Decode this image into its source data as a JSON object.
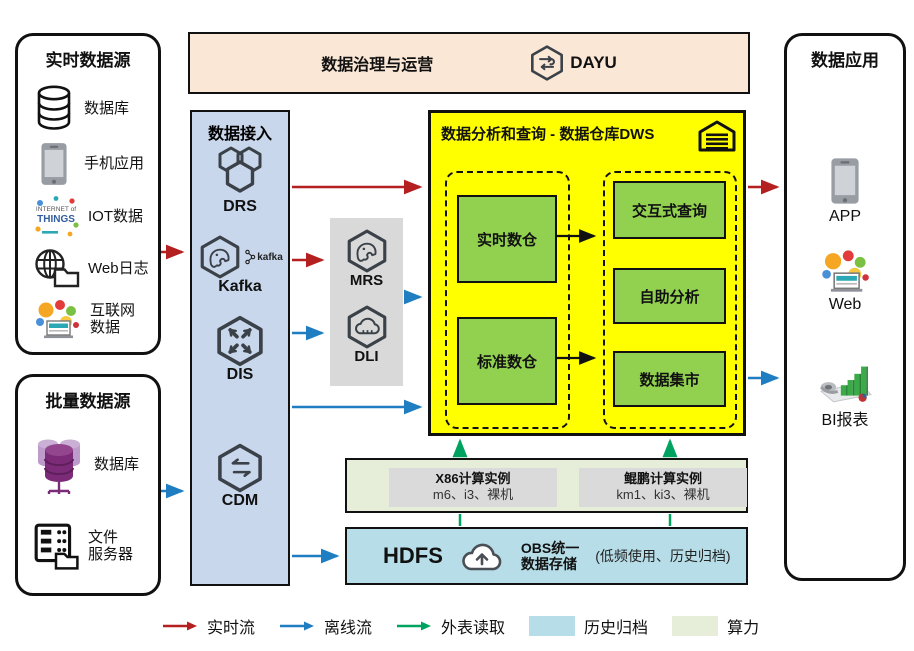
{
  "realtime_panel": {
    "title": "实时数据源",
    "items": [
      {
        "label": "数据库"
      },
      {
        "label": "手机应用"
      },
      {
        "label": "IOT数据"
      },
      {
        "label": "Web日志"
      },
      {
        "label": "互联网\n数据"
      }
    ]
  },
  "batch_panel": {
    "title": "批量数据源",
    "items": [
      {
        "label": "数据库"
      },
      {
        "label": "文件\n服务器"
      }
    ]
  },
  "governance": {
    "title": "数据治理与运营",
    "logo_text": "DAYU"
  },
  "ingestion": {
    "title": "数据接入",
    "kafka_badge": "kafka",
    "services": [
      {
        "label": "DRS"
      },
      {
        "label": "Kafka"
      },
      {
        "label": "DIS"
      },
      {
        "label": "CDM"
      }
    ]
  },
  "processing": {
    "services": [
      {
        "label": "MRS"
      },
      {
        "label": "DLI"
      }
    ]
  },
  "dws": {
    "title": "数据分析和查询 - 数据仓库DWS",
    "warehouses": [
      {
        "label": "实时数仓"
      },
      {
        "label": "标准数仓"
      }
    ],
    "services": [
      {
        "label": "交互式查询"
      },
      {
        "label": "自助分析"
      },
      {
        "label": "数据集市"
      }
    ]
  },
  "compute": {
    "groups": [
      {
        "title": "X86计算实例",
        "subtitle": "m6、i3、裸机"
      },
      {
        "title": "鲲鹏计算实例",
        "subtitle": "km1、ki3、裸机"
      }
    ]
  },
  "storage": {
    "hdfs_label": "HDFS",
    "obs_label": "OBS统一\n数据存储",
    "note": "(低频使用、历史归档)"
  },
  "apps_panel": {
    "title": "数据应用",
    "items": [
      {
        "label": "APP"
      },
      {
        "label": "Web"
      },
      {
        "label": "BI报表"
      }
    ]
  },
  "legend": {
    "items": [
      {
        "label": "实时流"
      },
      {
        "label": "离线流"
      },
      {
        "label": "外表读取"
      },
      {
        "label": "历史归档"
      },
      {
        "label": "算力"
      }
    ]
  },
  "icons": {
    "iot_line1": "INTERNET of",
    "iot_line2": "THINGS"
  },
  "colors": {
    "realtime_flow": "#B41F1F",
    "offline_flow": "#1F7EC2",
    "external_read": "#00A25F",
    "history_archive": "#B7DEE8",
    "compute_power": "#E6EDD8",
    "dws_bg": "#FFFF00",
    "warehouse_green": "#92D050",
    "ingestion_bg": "#C9D7EC",
    "banner_bg": "#FBE7D6"
  }
}
